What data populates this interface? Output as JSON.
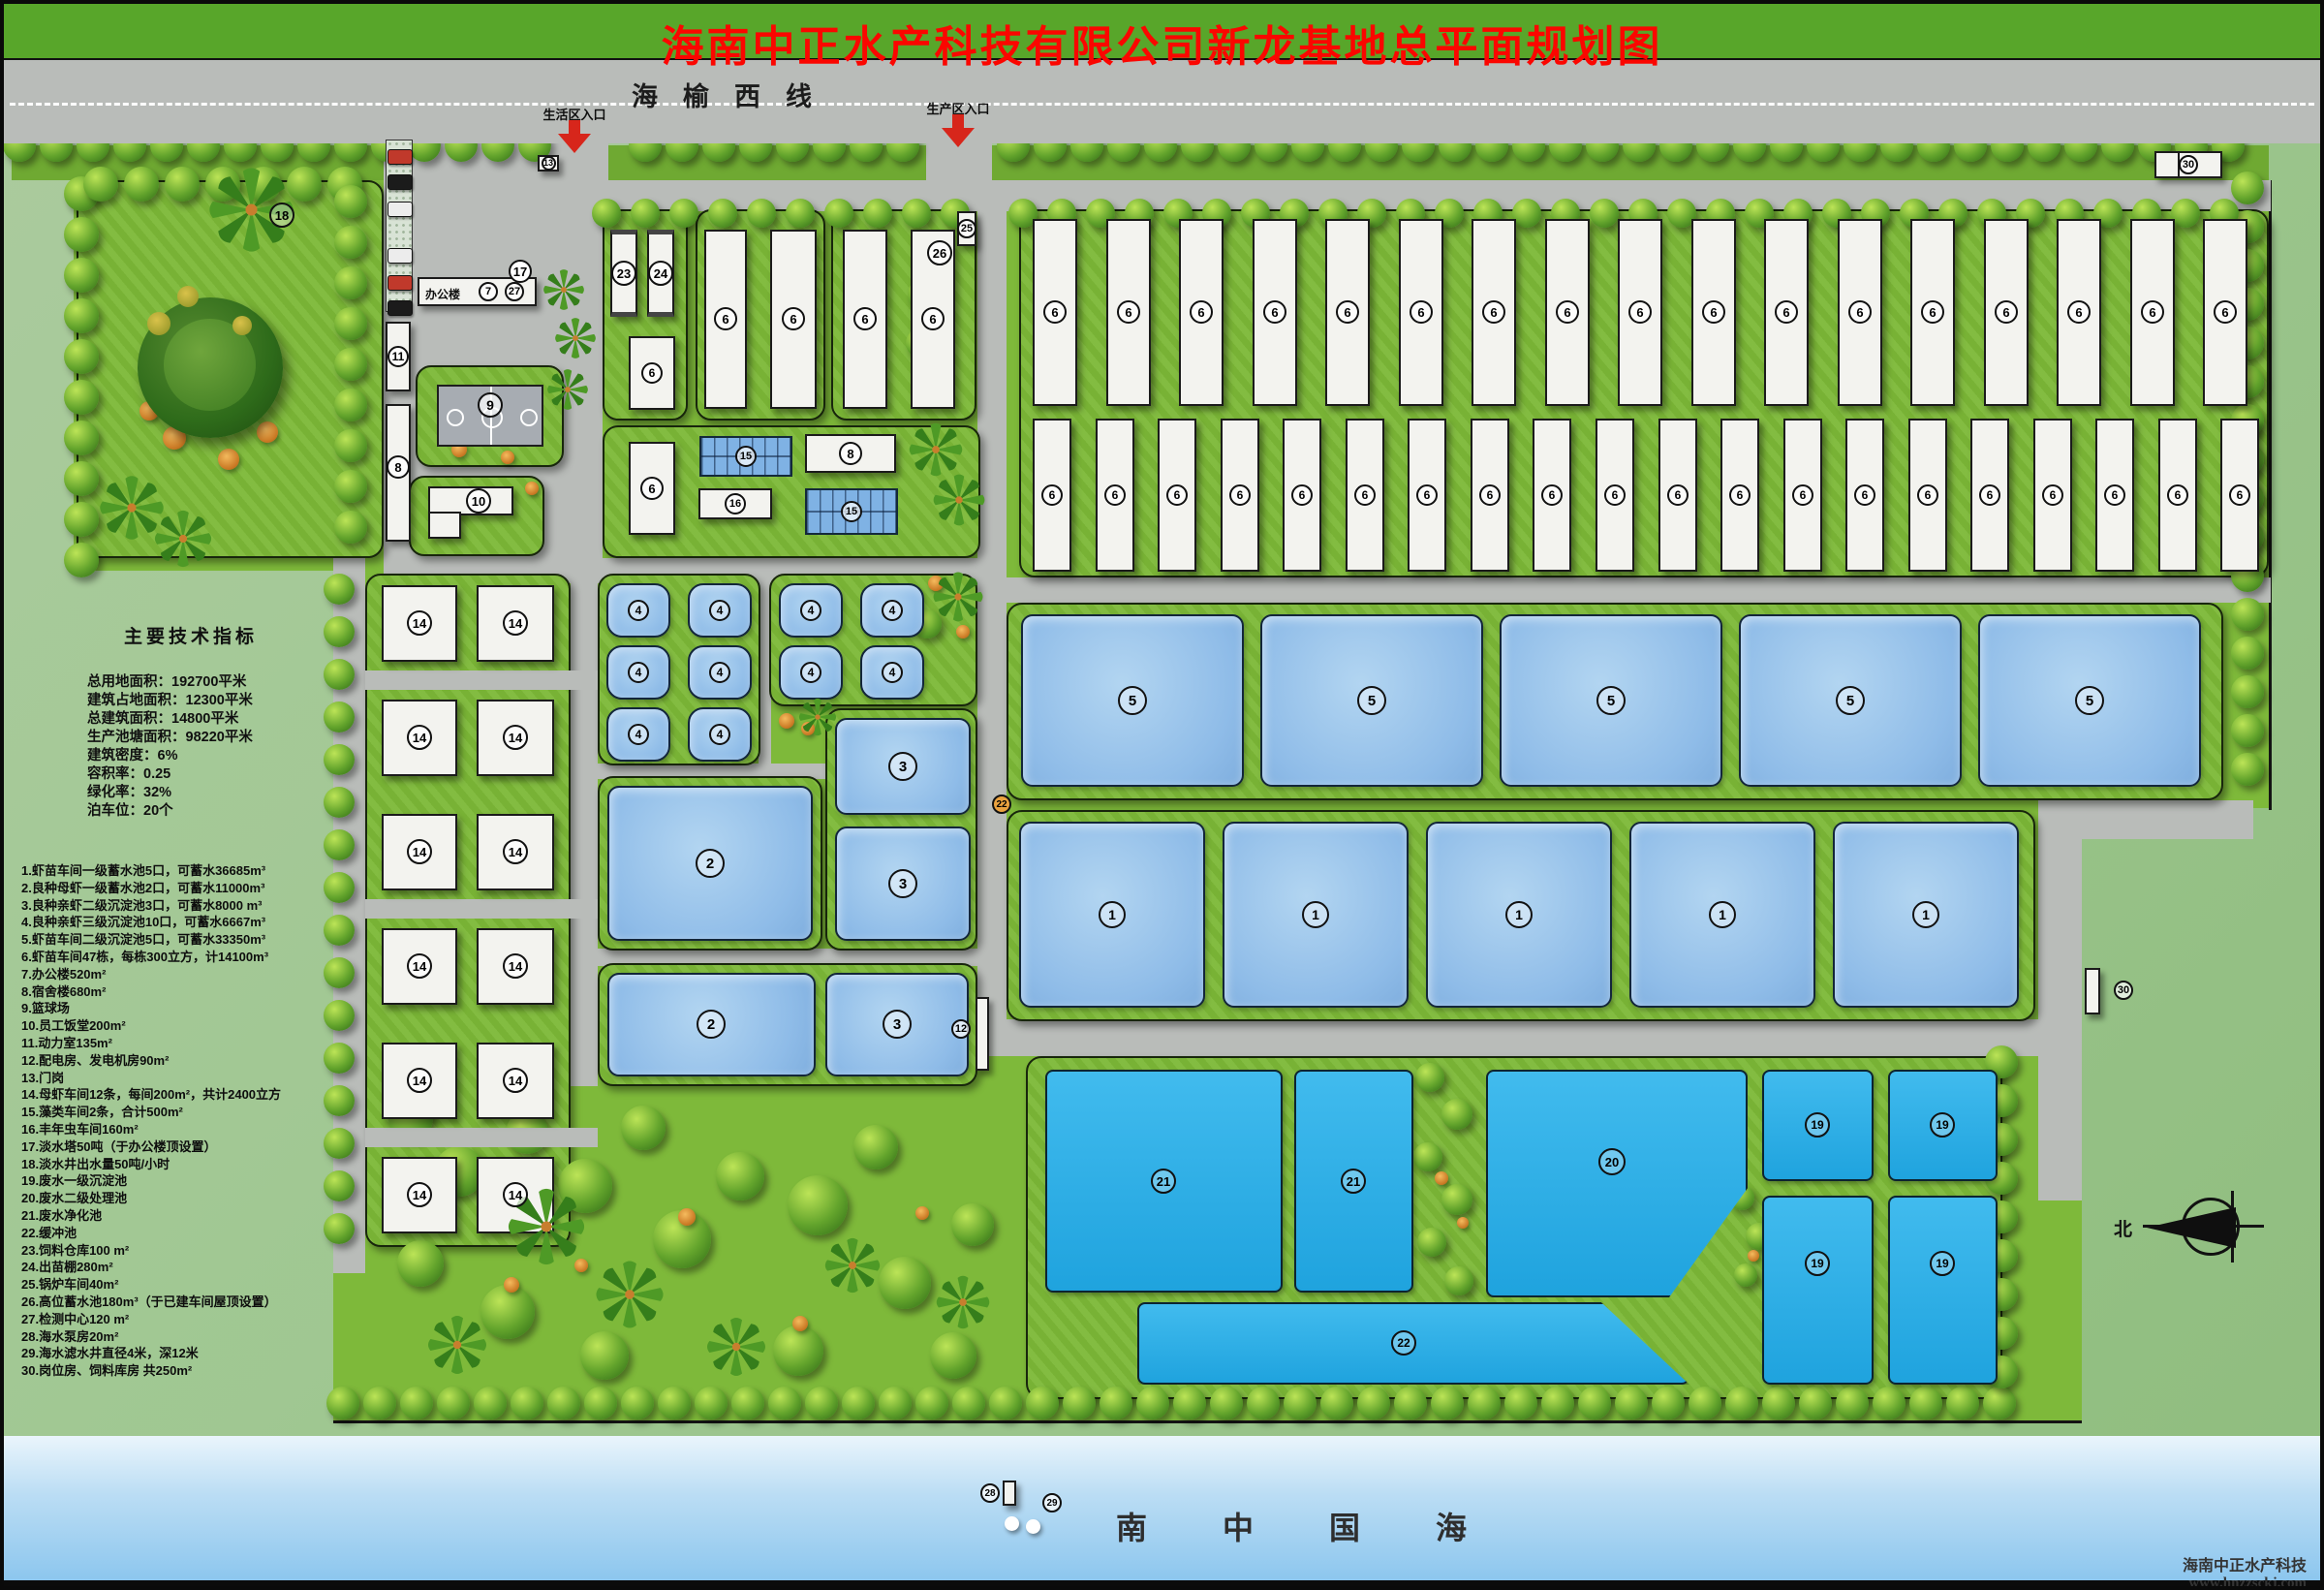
{
  "banner": {
    "title": "海南中正水产科技有限公司新龙基地总平面规划图"
  },
  "road": {
    "name": "海榆西线",
    "life_entrance": "生活区入口",
    "production_entrance": "生产区入口"
  },
  "tech": {
    "heading": "主要技术指标",
    "lines": [
      "总用地面积：192700平米",
      "建筑占地面积：12300平米",
      "总建筑面积：14800平米",
      "生产池塘面积：98220平米",
      "建筑密度：6%",
      "容积率：0.25",
      "绿化率：32%",
      "泊车位：20个"
    ]
  },
  "legend": [
    "1.虾苗车间一级蓄水池5口，可蓄水36685m³",
    "2.良种母虾一级蓄水池2口，可蓄水11000m³",
    "3.良种亲虾二级沉淀池3口，可蓄水8000 m³",
    "4.良种亲虾三级沉淀池10口，可蓄水6667m³",
    "5.虾苗车间二级沉淀池5口，可蓄水33350m³",
    "6.虾苗车间47栋，每栋300立方，计14100m³",
    "7.办公楼520m²",
    "8.宿舍楼680m²",
    "9.篮球场",
    "10.员工饭堂200m²",
    "11.动力室135m²",
    "12.配电房、发电机房90m²",
    "13.门岗",
    "14.母虾车间12条，每间200m²，共计2400立方",
    "15.藻类车间2条，合计500m²",
    "16.丰年虫车间160m²",
    "17.淡水塔50吨（于办公楼顶设置）",
    "18.淡水井出水量50吨/小时",
    "19.废水一级沉淀池",
    "20.废水二级处理池",
    "21.废水净化池",
    "22.缓冲池",
    "23.饲料仓库100 m²",
    "24.出苗棚280m²",
    "25.锅炉车间40m²",
    "26.高位蓄水池180m³（于已建车间屋顶设置）",
    "27.检测中心120 m²",
    "28.海水泵房20m²",
    "29.海水滤水井直径4米，深12米",
    "30.岗位房、饲料库房 共250m²"
  ],
  "sea": {
    "name": "南中国海"
  },
  "watermark": {
    "company": "海南中正水产科技",
    "website": "www.hnzzsckj.com"
  },
  "compass": {
    "north": "北"
  },
  "map": {
    "office_label": "办公楼",
    "nums": {
      "n1": "1",
      "n2": "2",
      "n3": "3",
      "n4": "4",
      "n5": "5",
      "n6": "6",
      "n7": "7",
      "n8": "8",
      "n9": "9",
      "n10": "10",
      "n11": "11",
      "n12": "12",
      "n13": "13",
      "n14": "14",
      "n15": "15",
      "n16": "16",
      "n17": "17",
      "n18": "18",
      "n19": "19",
      "n20": "20",
      "n21": "21",
      "n22": "22",
      "n23": "23",
      "n24": "24",
      "n25": "25",
      "n26": "26",
      "n27": "27",
      "n28": "28",
      "n29": "29",
      "n30": "30"
    },
    "counts": {
      "workshop_row1": 17,
      "workshop_row2": 20,
      "mother_shrimp_buildings": 12,
      "pond4": 10,
      "pond5": 5,
      "pond1": 5
    }
  }
}
